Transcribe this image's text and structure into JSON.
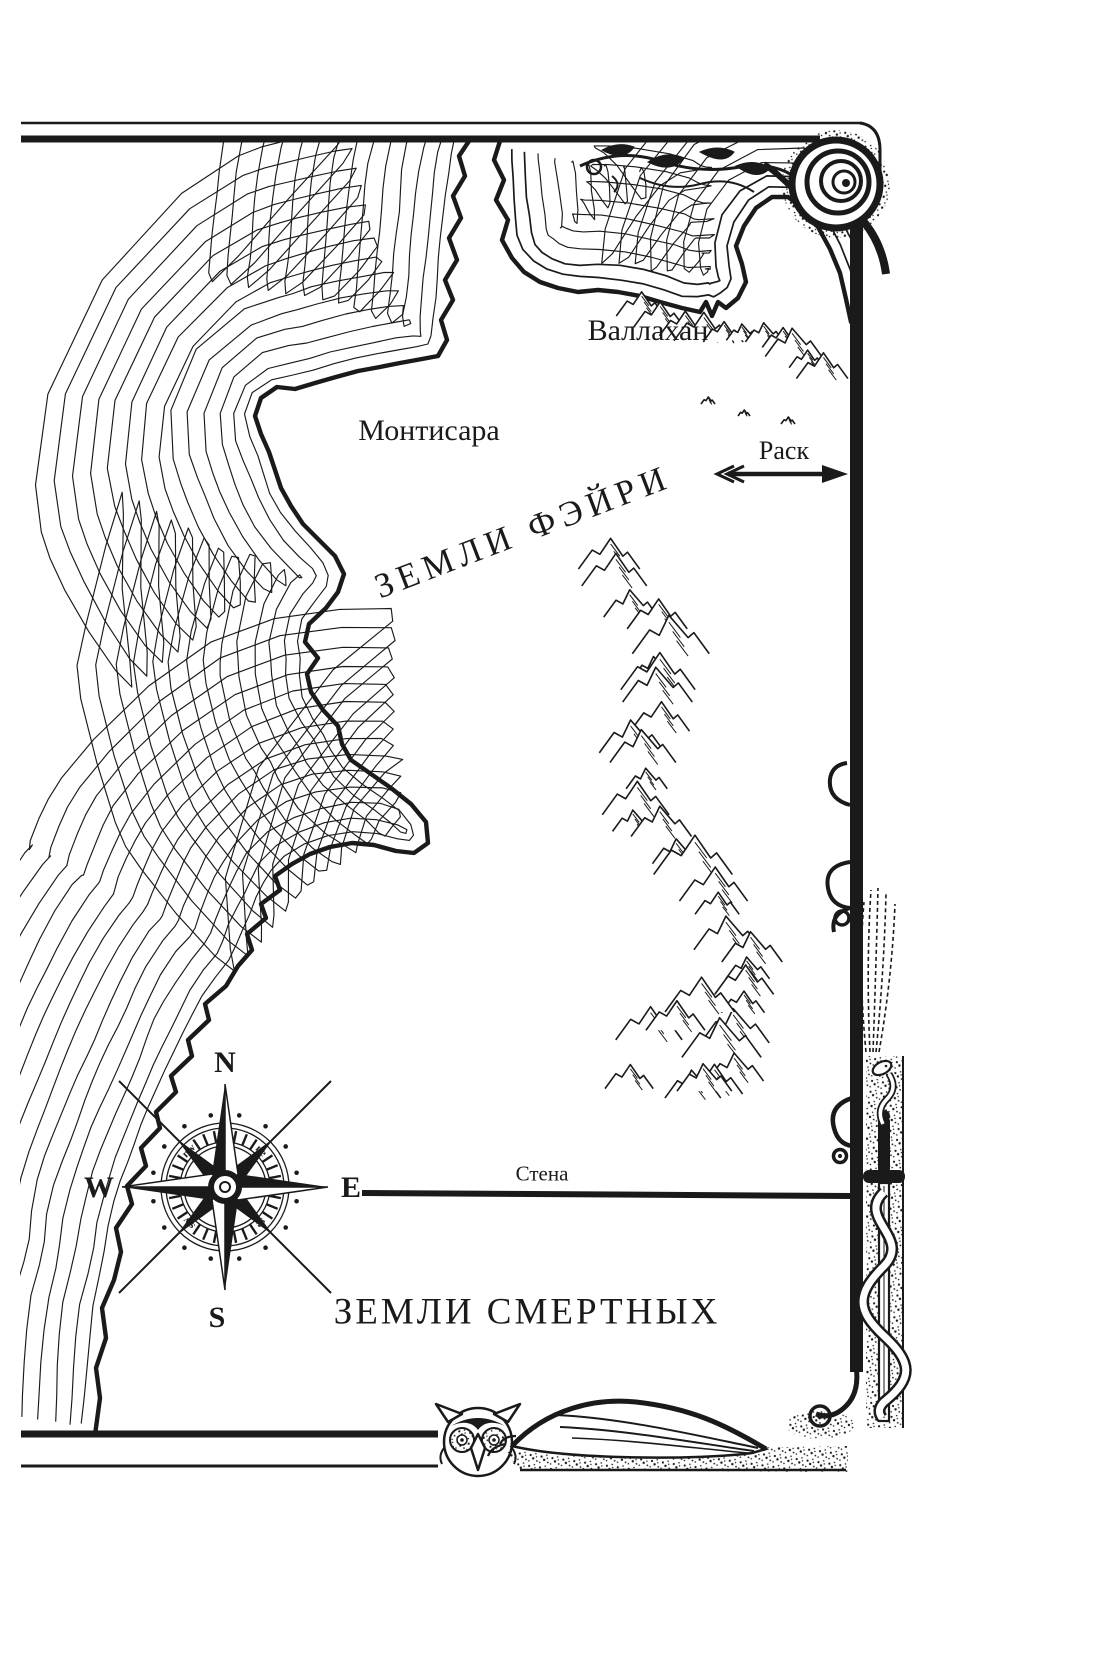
{
  "map": {
    "regions": {
      "fairy": "ЗЕМЛИ ФЭЙРИ",
      "mortal": "ЗЕМЛИ СМЕРТНЫХ"
    },
    "places": {
      "vallahan": "Валлахан",
      "montisara": "Монтисара",
      "rask": "Раск"
    },
    "wall_label": "Стена",
    "compass": {
      "n": "N",
      "e": "E",
      "s": "S",
      "w": "W",
      "nw": "nw",
      "ne": "ne",
      "sw": "sw",
      "se": "se"
    },
    "colors": {
      "ink": "#1a1a1a",
      "paper": "#ffffff"
    }
  }
}
